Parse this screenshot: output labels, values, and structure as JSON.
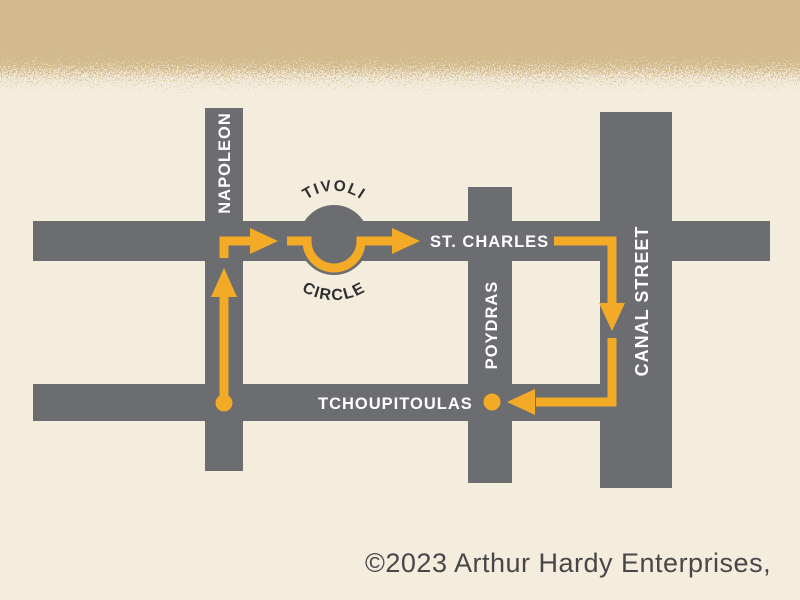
{
  "map": {
    "streets": {
      "napoleon": "NAPOLEON",
      "st_charles": "ST. CHARLES",
      "poydras": "POYDRAS",
      "canal": "CANAL STREET",
      "tchoupitoulas": "TCHOUPITOULAS"
    },
    "landmark": {
      "tivoli_top": "TIVOLI",
      "tivoli_bottom": "CIRCLE"
    },
    "colors": {
      "street": "#6c6d71",
      "route": "#f3ab27",
      "background": "#f4edde",
      "band": "#d3ba8c",
      "street_label": "#ffffff",
      "dark_text": "#2e2f31"
    }
  },
  "footer": {
    "copyright": "©2023 Arthur Hardy Enterprises,"
  }
}
